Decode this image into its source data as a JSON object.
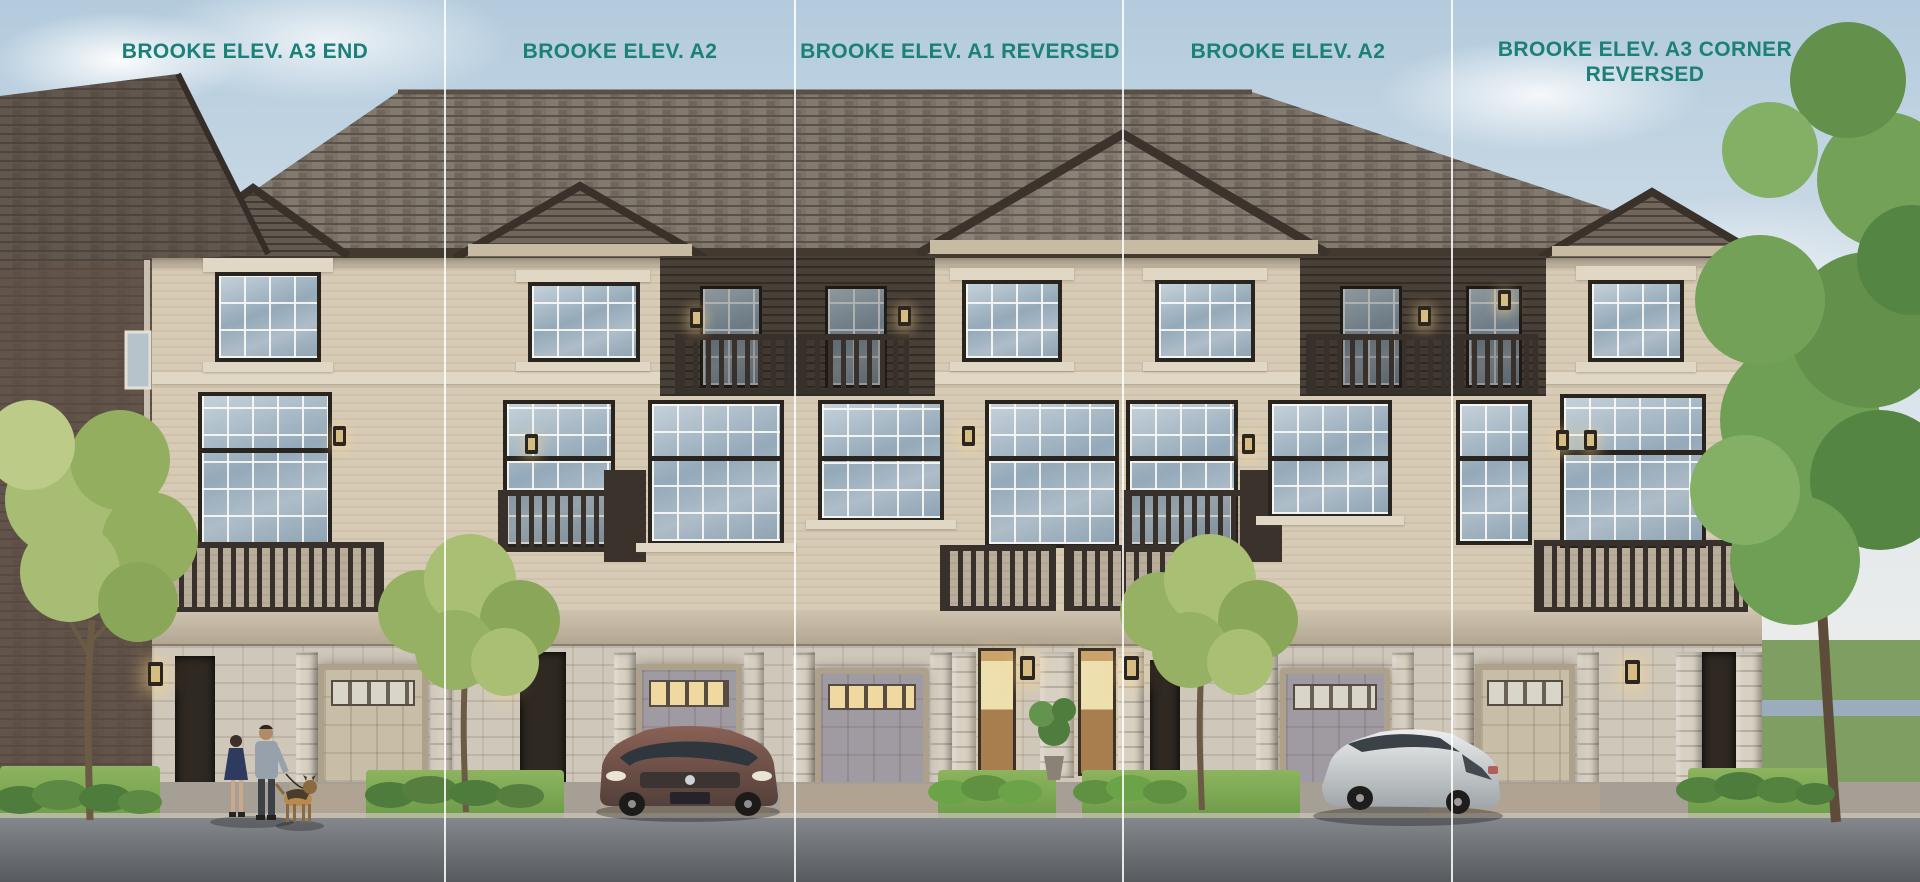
{
  "captions": [
    {
      "text": "BROOKE ELEV. A3 END"
    },
    {
      "text": "BROOKE ELEV. A2"
    },
    {
      "text": "BROOKE ELEV. A1 REVERSED"
    },
    {
      "text": "BROOKE ELEV. A2"
    },
    {
      "text": "BROOKE ELEV. A3 CORNER REVERSED"
    }
  ],
  "colors": {
    "caption_teal": "#1a8078",
    "divider_white": "#ffffff",
    "sky_blue": "#b3cbdd",
    "brick_beige": "#d7cbb6",
    "roof_brown": "#756a5f"
  }
}
